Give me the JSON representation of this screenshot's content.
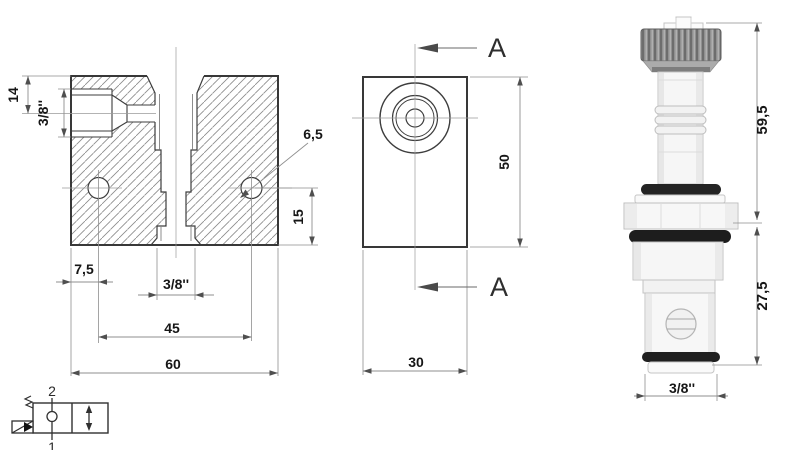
{
  "front_view": {
    "dim_port_depth": "14",
    "dim_side_port": "3/8''",
    "dim_mount_hole": "6,5",
    "dim_hole_to_bottom": "15",
    "dim_edge_to_hole": "7,5",
    "dim_bottom_port": "3/8''",
    "dim_hole_spacing": "45",
    "dim_width": "60"
  },
  "section_view": {
    "label_top": "A",
    "label_bottom": "A",
    "dim_height": "50",
    "dim_depth": "30"
  },
  "cartridge_view": {
    "dim_upper_length": "59,5",
    "dim_cartridge_length": "27,5",
    "dim_thread": "3/8''"
  },
  "schematic_symbol": {
    "port_top_label": "2",
    "port_bottom_label": "1"
  },
  "colors": {
    "drawing_line": "#3d3d3d",
    "dimension_line": "#8f8f8f",
    "text": "#161616",
    "o_ring_black": "#1d1d1d",
    "knurl_gray": "#8a8a8a"
  }
}
